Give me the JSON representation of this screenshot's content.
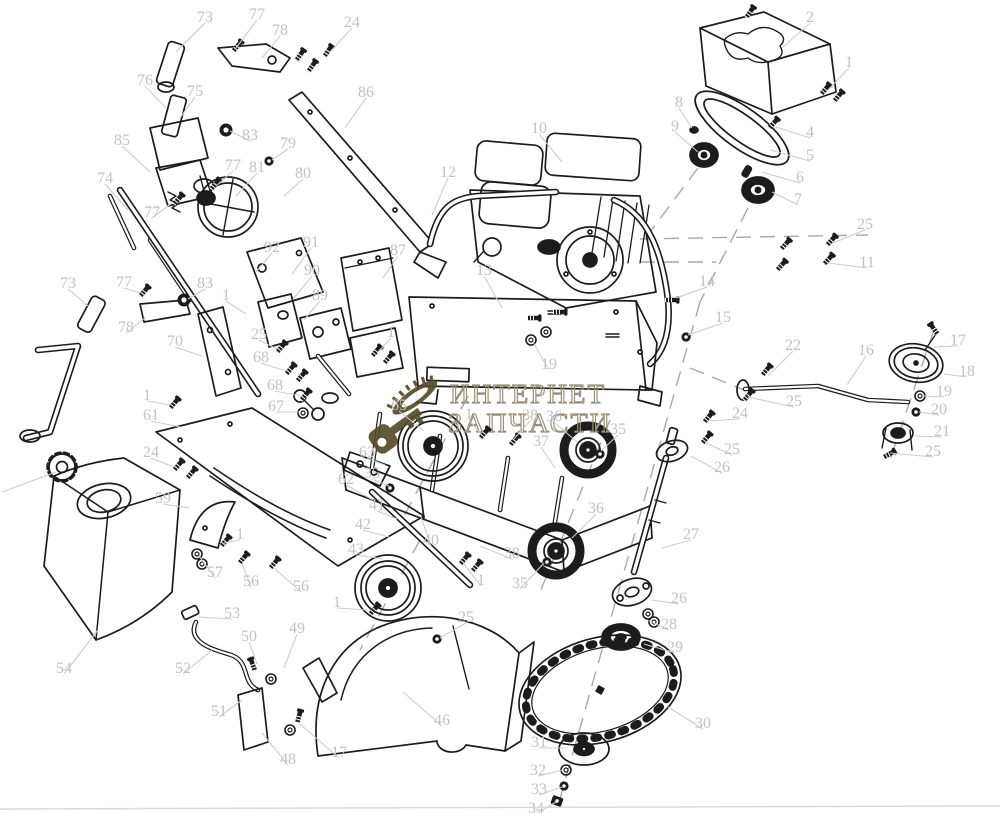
{
  "diagram": {
    "type": "exploded-parts-diagram",
    "background": "#ffffff",
    "ink_color": "#1c1c1c",
    "label_color": "#c2c2c2",
    "leader_color": "#cdcdcd",
    "dash_color": "#a9a9a9",
    "watermark": {
      "line1": "ИНТЕРНЕТ",
      "line2": "ЗАПЧАСТИ",
      "text_color": "#9a9078",
      "logo": "key-and-saw-bar-icon",
      "logo_color": "#584b2c"
    },
    "part_labels": [
      [
        "73",
        205,
        17,
        176,
        52
      ],
      [
        "77",
        257,
        14,
        236,
        48
      ],
      [
        "78",
        280,
        30,
        262,
        58
      ],
      [
        "24",
        352,
        22,
        330,
        52
      ],
      [
        "76",
        145,
        80,
        166,
        108
      ],
      [
        "75",
        195,
        91,
        180,
        118
      ],
      [
        "86",
        366,
        92,
        345,
        128
      ],
      [
        "85",
        122,
        140,
        150,
        172
      ],
      [
        "83",
        250,
        135,
        230,
        131
      ],
      [
        "74",
        105,
        178,
        128,
        210
      ],
      [
        "79",
        288,
        143,
        272,
        160
      ],
      [
        "77",
        233,
        165,
        216,
        186
      ],
      [
        "81",
        257,
        167,
        236,
        196
      ],
      [
        "80",
        303,
        173,
        284,
        196
      ],
      [
        "77",
        152,
        212,
        172,
        203
      ],
      [
        "12",
        448,
        172,
        432,
        215
      ],
      [
        "10",
        539,
        128,
        562,
        162
      ],
      [
        "8",
        679,
        102,
        692,
        128
      ],
      [
        "9",
        675,
        126,
        698,
        152
      ],
      [
        "2",
        810,
        17,
        782,
        48
      ],
      [
        "1",
        849,
        62,
        828,
        90
      ],
      [
        "4",
        810,
        132,
        776,
        127
      ],
      [
        "5",
        810,
        155,
        770,
        150
      ],
      [
        "6",
        800,
        177,
        762,
        172
      ],
      [
        "7",
        798,
        199,
        772,
        192
      ],
      [
        "25",
        865,
        224,
        833,
        243
      ],
      [
        "11",
        867,
        262,
        828,
        263
      ],
      [
        "14",
        707,
        281,
        676,
        298
      ],
      [
        "15",
        723,
        317,
        688,
        335
      ],
      [
        "87",
        398,
        250,
        383,
        278
      ],
      [
        "13",
        484,
        270,
        502,
        308
      ],
      [
        "19",
        549,
        364,
        533,
        342
      ],
      [
        "1",
        391,
        332,
        378,
        352
      ],
      [
        "92",
        272,
        247,
        256,
        272
      ],
      [
        "91",
        311,
        242,
        292,
        274
      ],
      [
        "90",
        312,
        270,
        294,
        298
      ],
      [
        "89",
        320,
        295,
        304,
        320
      ],
      [
        "25",
        259,
        334,
        277,
        349
      ],
      [
        "68",
        261,
        357,
        286,
        371
      ],
      [
        "68",
        275,
        385,
        300,
        396
      ],
      [
        "67",
        276,
        406,
        301,
        412
      ],
      [
        "1",
        147,
        395,
        170,
        405
      ],
      [
        "61",
        151,
        415,
        180,
        427
      ],
      [
        "70",
        175,
        341,
        202,
        356
      ],
      [
        "1",
        226,
        295,
        246,
        314
      ],
      [
        "83",
        205,
        283,
        188,
        299
      ],
      [
        "77",
        124,
        282,
        140,
        293
      ],
      [
        "73",
        68,
        283,
        88,
        306
      ],
      [
        "78",
        126,
        327,
        146,
        317
      ],
      [
        "24",
        151,
        452,
        174,
        467
      ],
      [
        "59",
        163,
        498,
        190,
        508
      ],
      [
        "57",
        215,
        572,
        199,
        556
      ],
      [
        "56",
        251,
        581,
        242,
        563
      ],
      [
        "56",
        301,
        586,
        273,
        567
      ],
      [
        "1",
        240,
        534,
        224,
        543
      ],
      [
        "53",
        232,
        613,
        198,
        617
      ],
      [
        "54",
        64,
        668,
        98,
        630
      ],
      [
        "50",
        249,
        636,
        257,
        664
      ],
      [
        "49",
        297,
        628,
        284,
        668
      ],
      [
        "52",
        183,
        668,
        212,
        650
      ],
      [
        "51",
        219,
        711,
        242,
        700
      ],
      [
        "48",
        288,
        759,
        262,
        733
      ],
      [
        "17",
        339,
        752,
        300,
        724
      ],
      [
        "1",
        337,
        602,
        368,
        610
      ],
      [
        "25",
        466,
        617,
        440,
        638
      ],
      [
        "46",
        442,
        720,
        403,
        692
      ],
      [
        "65",
        399,
        405,
        424,
        431
      ],
      [
        "1",
        469,
        414,
        481,
        434
      ],
      [
        "38",
        530,
        415,
        513,
        440
      ],
      [
        "36",
        554,
        416,
        577,
        442
      ],
      [
        "35",
        618,
        429,
        601,
        451
      ],
      [
        "37",
        541,
        441,
        555,
        468
      ],
      [
        "63",
        367,
        452,
        385,
        465
      ],
      [
        "35",
        372,
        473,
        389,
        486
      ],
      [
        "62",
        346,
        479,
        373,
        500
      ],
      [
        "41",
        377,
        505,
        397,
        519
      ],
      [
        "42",
        363,
        524,
        389,
        537
      ],
      [
        "43",
        356,
        549,
        383,
        559
      ],
      [
        "40",
        431,
        540,
        421,
        517
      ],
      [
        "38",
        512,
        553,
        480,
        546
      ],
      [
        "1",
        481,
        580,
        464,
        564
      ],
      [
        "35",
        520,
        583,
        544,
        563
      ],
      [
        "36",
        596,
        508,
        572,
        538
      ],
      [
        "27",
        691,
        534,
        662,
        548
      ],
      [
        "26",
        722,
        467,
        691,
        456
      ],
      [
        "25",
        732,
        449,
        706,
        443
      ],
      [
        "26",
        679,
        598,
        652,
        600
      ],
      [
        "28",
        669,
        624,
        649,
        621
      ],
      [
        "29",
        675,
        647,
        644,
        644
      ],
      [
        "30",
        703,
        723,
        668,
        707
      ],
      [
        "31",
        539,
        742,
        566,
        748
      ],
      [
        "32",
        538,
        770,
        563,
        770
      ],
      [
        "33",
        539,
        789,
        562,
        787
      ],
      [
        "34",
        536,
        808,
        556,
        802
      ],
      [
        "22",
        793,
        345,
        768,
        376
      ],
      [
        "16",
        866,
        350,
        847,
        385
      ],
      [
        "17",
        958,
        340,
        934,
        347
      ],
      [
        "18",
        967,
        371,
        944,
        374
      ],
      [
        "19",
        944,
        391,
        923,
        396
      ],
      [
        "20",
        939,
        409,
        919,
        412
      ],
      [
        "21",
        942,
        431,
        915,
        436
      ],
      [
        "25",
        933,
        451,
        890,
        453
      ],
      [
        "25",
        794,
        401,
        748,
        397
      ],
      [
        "24",
        740,
        413,
        708,
        421
      ]
    ],
    "hardware": [
      {
        "t": "bolt",
        "x": 298,
        "y": 58,
        "r": 35
      },
      {
        "t": "bolt",
        "x": 310,
        "y": 69,
        "r": 35
      },
      {
        "t": "bolt",
        "x": 326,
        "y": 54,
        "r": 35
      },
      {
        "t": "bolt",
        "x": 235,
        "y": 49,
        "r": 40
      },
      {
        "t": "bolt",
        "x": 748,
        "y": 15,
        "r": 35
      },
      {
        "t": "bolt",
        "x": 823,
        "y": 92,
        "r": 40
      },
      {
        "t": "bolt",
        "x": 836,
        "y": 99,
        "r": 40
      },
      {
        "t": "bolt",
        "x": 771,
        "y": 126,
        "r": 42
      },
      {
        "t": "bolt",
        "x": 764,
        "y": 373,
        "r": 40
      },
      {
        "t": "bolt",
        "x": 783,
        "y": 247,
        "r": 42
      },
      {
        "t": "bolt",
        "x": 829,
        "y": 243,
        "r": 42
      },
      {
        "t": "bolt",
        "x": 779,
        "y": 268,
        "r": 42
      },
      {
        "t": "bolt",
        "x": 826,
        "y": 262,
        "r": 42
      },
      {
        "t": "bolt",
        "x": 668,
        "y": 300,
        "r": 90
      },
      {
        "t": "nut",
        "x": 686,
        "y": 337,
        "r": 0
      },
      {
        "t": "bolt",
        "x": 213,
        "y": 187,
        "r": 40
      },
      {
        "t": "bolt",
        "x": 176,
        "y": 202,
        "r": 40
      },
      {
        "t": "bolt",
        "x": 142,
        "y": 294,
        "r": 40
      },
      {
        "t": "bush",
        "x": 226,
        "y": 130,
        "r": 0
      },
      {
        "t": "bush",
        "x": 184,
        "y": 300,
        "r": 0
      },
      {
        "t": "nut",
        "x": 269,
        "y": 161,
        "r": 0
      },
      {
        "t": "bolt",
        "x": 374,
        "y": 354,
        "r": 40
      },
      {
        "t": "bolt",
        "x": 386,
        "y": 361,
        "r": 40
      },
      {
        "t": "bolt",
        "x": 279,
        "y": 350,
        "r": 40
      },
      {
        "t": "bolt",
        "x": 288,
        "y": 372,
        "r": 40
      },
      {
        "t": "bolt",
        "x": 299,
        "y": 379,
        "r": 40
      },
      {
        "t": "bolt",
        "x": 303,
        "y": 398,
        "r": 40
      },
      {
        "t": "washer",
        "x": 303,
        "y": 413,
        "r": 0
      },
      {
        "t": "bolt",
        "x": 172,
        "y": 406,
        "r": 40
      },
      {
        "t": "bolt",
        "x": 176,
        "y": 468,
        "r": 40
      },
      {
        "t": "bolt",
        "x": 189,
        "y": 476,
        "r": 40
      },
      {
        "t": "washer",
        "x": 197,
        "y": 554,
        "r": 0
      },
      {
        "t": "washer",
        "x": 202,
        "y": 564,
        "r": 0
      },
      {
        "t": "bolt",
        "x": 241,
        "y": 561,
        "r": 40
      },
      {
        "t": "bolt",
        "x": 272,
        "y": 566,
        "r": 40
      },
      {
        "t": "bolt",
        "x": 223,
        "y": 544,
        "r": 40
      },
      {
        "t": "bolt",
        "x": 372,
        "y": 612,
        "r": 40
      },
      {
        "t": "bolt",
        "x": 298,
        "y": 720,
        "r": 15
      },
      {
        "t": "washer",
        "x": 290,
        "y": 730,
        "r": 0
      },
      {
        "t": "bolt",
        "x": 462,
        "y": 562,
        "r": 40
      },
      {
        "t": "bolt",
        "x": 474,
        "y": 569,
        "r": 40
      },
      {
        "t": "nut",
        "x": 547,
        "y": 562,
        "r": 0
      },
      {
        "t": "nut",
        "x": 600,
        "y": 454,
        "r": 0
      },
      {
        "t": "washer",
        "x": 531,
        "y": 340,
        "r": 0
      },
      {
        "t": "washer",
        "x": 546,
        "y": 332,
        "r": 0
      },
      {
        "t": "bolt",
        "x": 530,
        "y": 318,
        "r": 90
      },
      {
        "t": "bolt",
        "x": 556,
        "y": 312,
        "r": 90
      },
      {
        "t": "bolt",
        "x": 704,
        "y": 441,
        "r": 40
      },
      {
        "t": "bolt",
        "x": 706,
        "y": 420,
        "r": 40
      },
      {
        "t": "bolt",
        "x": 746,
        "y": 398,
        "r": 40
      },
      {
        "t": "washer",
        "x": 648,
        "y": 614,
        "r": 0
      },
      {
        "t": "washer",
        "x": 654,
        "y": 622,
        "r": 0
      },
      {
        "t": "washer",
        "x": 920,
        "y": 396,
        "r": 0
      },
      {
        "t": "nut",
        "x": 916,
        "y": 412,
        "r": 0
      },
      {
        "t": "bolt",
        "x": 936,
        "y": 332,
        "r": -35
      },
      {
        "t": "bolt",
        "x": 886,
        "y": 456,
        "r": 60
      },
      {
        "t": "washer",
        "x": 566,
        "y": 770,
        "r": 0
      },
      {
        "t": "nut",
        "x": 564,
        "y": 786,
        "r": 0
      },
      {
        "t": "sqnut",
        "x": 557,
        "y": 801,
        "r": 20
      },
      {
        "t": "nut",
        "x": 437,
        "y": 639,
        "r": 0
      },
      {
        "t": "bolt",
        "x": 254,
        "y": 668,
        "r": -20
      },
      {
        "t": "washer",
        "x": 271,
        "y": 679,
        "r": 0
      },
      {
        "t": "bolt",
        "x": 512,
        "y": 443,
        "r": 40
      },
      {
        "t": "bolt",
        "x": 482,
        "y": 436,
        "r": 40
      },
      {
        "t": "nut",
        "x": 390,
        "y": 488,
        "r": 0
      }
    ]
  }
}
